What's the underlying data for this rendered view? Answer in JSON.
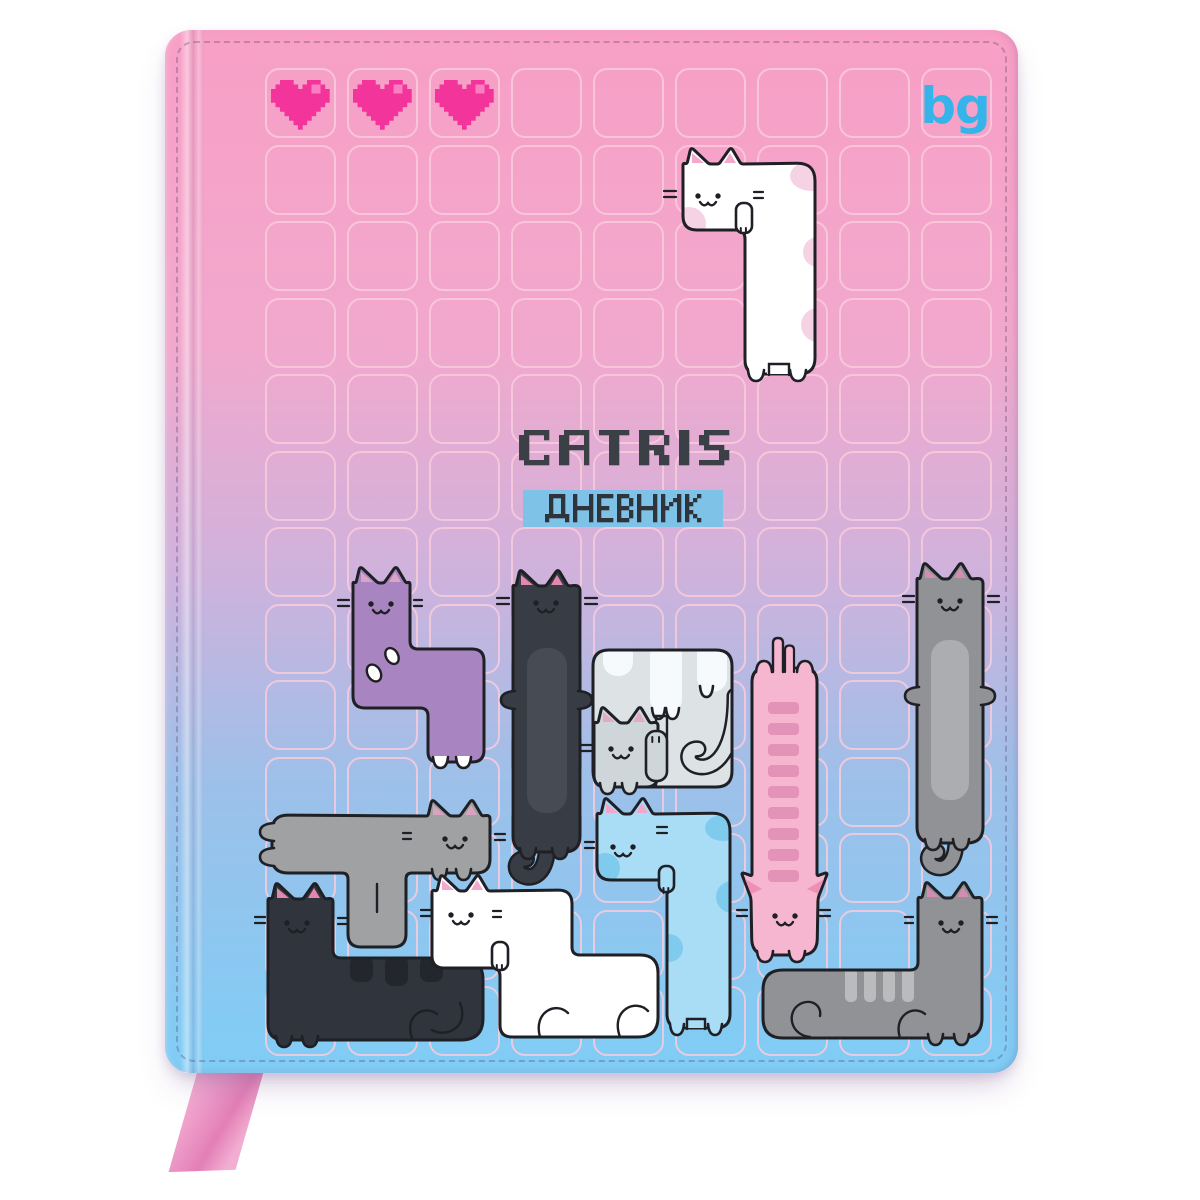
{
  "cover": {
    "brand_logo": "bg",
    "title": "CATRIS",
    "subtitle": "ДНЕВНИК",
    "hearts_count": 3,
    "colors": {
      "gradient_top": "#f89fc6",
      "gradient_upper": "#f2a8cd",
      "gradient_mid": "#cfb2dc",
      "gradient_lower": "#9dc0e9",
      "gradient_bottom": "#7fcdf6",
      "grid_line": "#f8cbdc",
      "outline": "#1e2025",
      "heart": "#f2349b",
      "heart_shine": "#f97fc1",
      "title_text": "#3b3f46",
      "subtitle_bg": "#7fc2e8",
      "subtitle_text": "#2f333a",
      "brand_color": "#35b4ea",
      "ribbon": "#ec97c6",
      "ribbon_light": "#f7b5d6"
    },
    "cats": [
      {
        "id": "white-long-cat",
        "label": "white long cat, J piece",
        "color": "#ffffff",
        "accent": "#f6d2e5",
        "ear": "#f5a8cd"
      },
      {
        "id": "purple-cat",
        "label": "purple cat, S piece",
        "color": "#a884c0",
        "accent": "#ffffff",
        "ear": "#dba3c6"
      },
      {
        "id": "black-long-cat",
        "label": "black long cat, I piece",
        "color": "#383c44",
        "accent": "#474b54",
        "ear": "#e387b0"
      },
      {
        "id": "block-cat",
        "label": "gray block with curtain and kitten, O piece",
        "color": "#dde2e4",
        "accent": "#f6fafc",
        "ear": "#e5a9c8",
        "kitten_color": "#cfd6d9"
      },
      {
        "id": "pink-ladder-cat",
        "label": "pink cat with ladder stripes, I piece",
        "color": "#f6b6cf",
        "accent": "#e392b8",
        "ear": "#ee8fb6"
      },
      {
        "id": "gray-long-cat",
        "label": "gray long cat, I piece",
        "color": "#909296",
        "accent": "#abadb0",
        "ear": "#d48cb0"
      },
      {
        "id": "gray-t-cat",
        "label": "gray cat, T piece",
        "color": "#9fa1a3",
        "accent": "#8a8c8e",
        "ear": "#d9a2bf"
      },
      {
        "id": "black-corner-cat",
        "label": "black cat, L piece",
        "color": "#30343c",
        "accent": "#23262c",
        "ear": "#e387b0"
      },
      {
        "id": "white-corner-cat",
        "label": "white cat, S piece",
        "color": "#ffffff",
        "accent": "#f6d2e5",
        "ear": "#f5a8cd"
      },
      {
        "id": "blue-cat",
        "label": "blue cat, J piece",
        "color": "#a9ddf6",
        "accent": "#7fcbee",
        "ear": "#f0a7c9"
      },
      {
        "id": "gray-corner-cat",
        "label": "gray cat, mirrored J piece",
        "color": "#909296",
        "accent": "#b9bbbd",
        "ear": "#d48cb0"
      }
    ]
  }
}
